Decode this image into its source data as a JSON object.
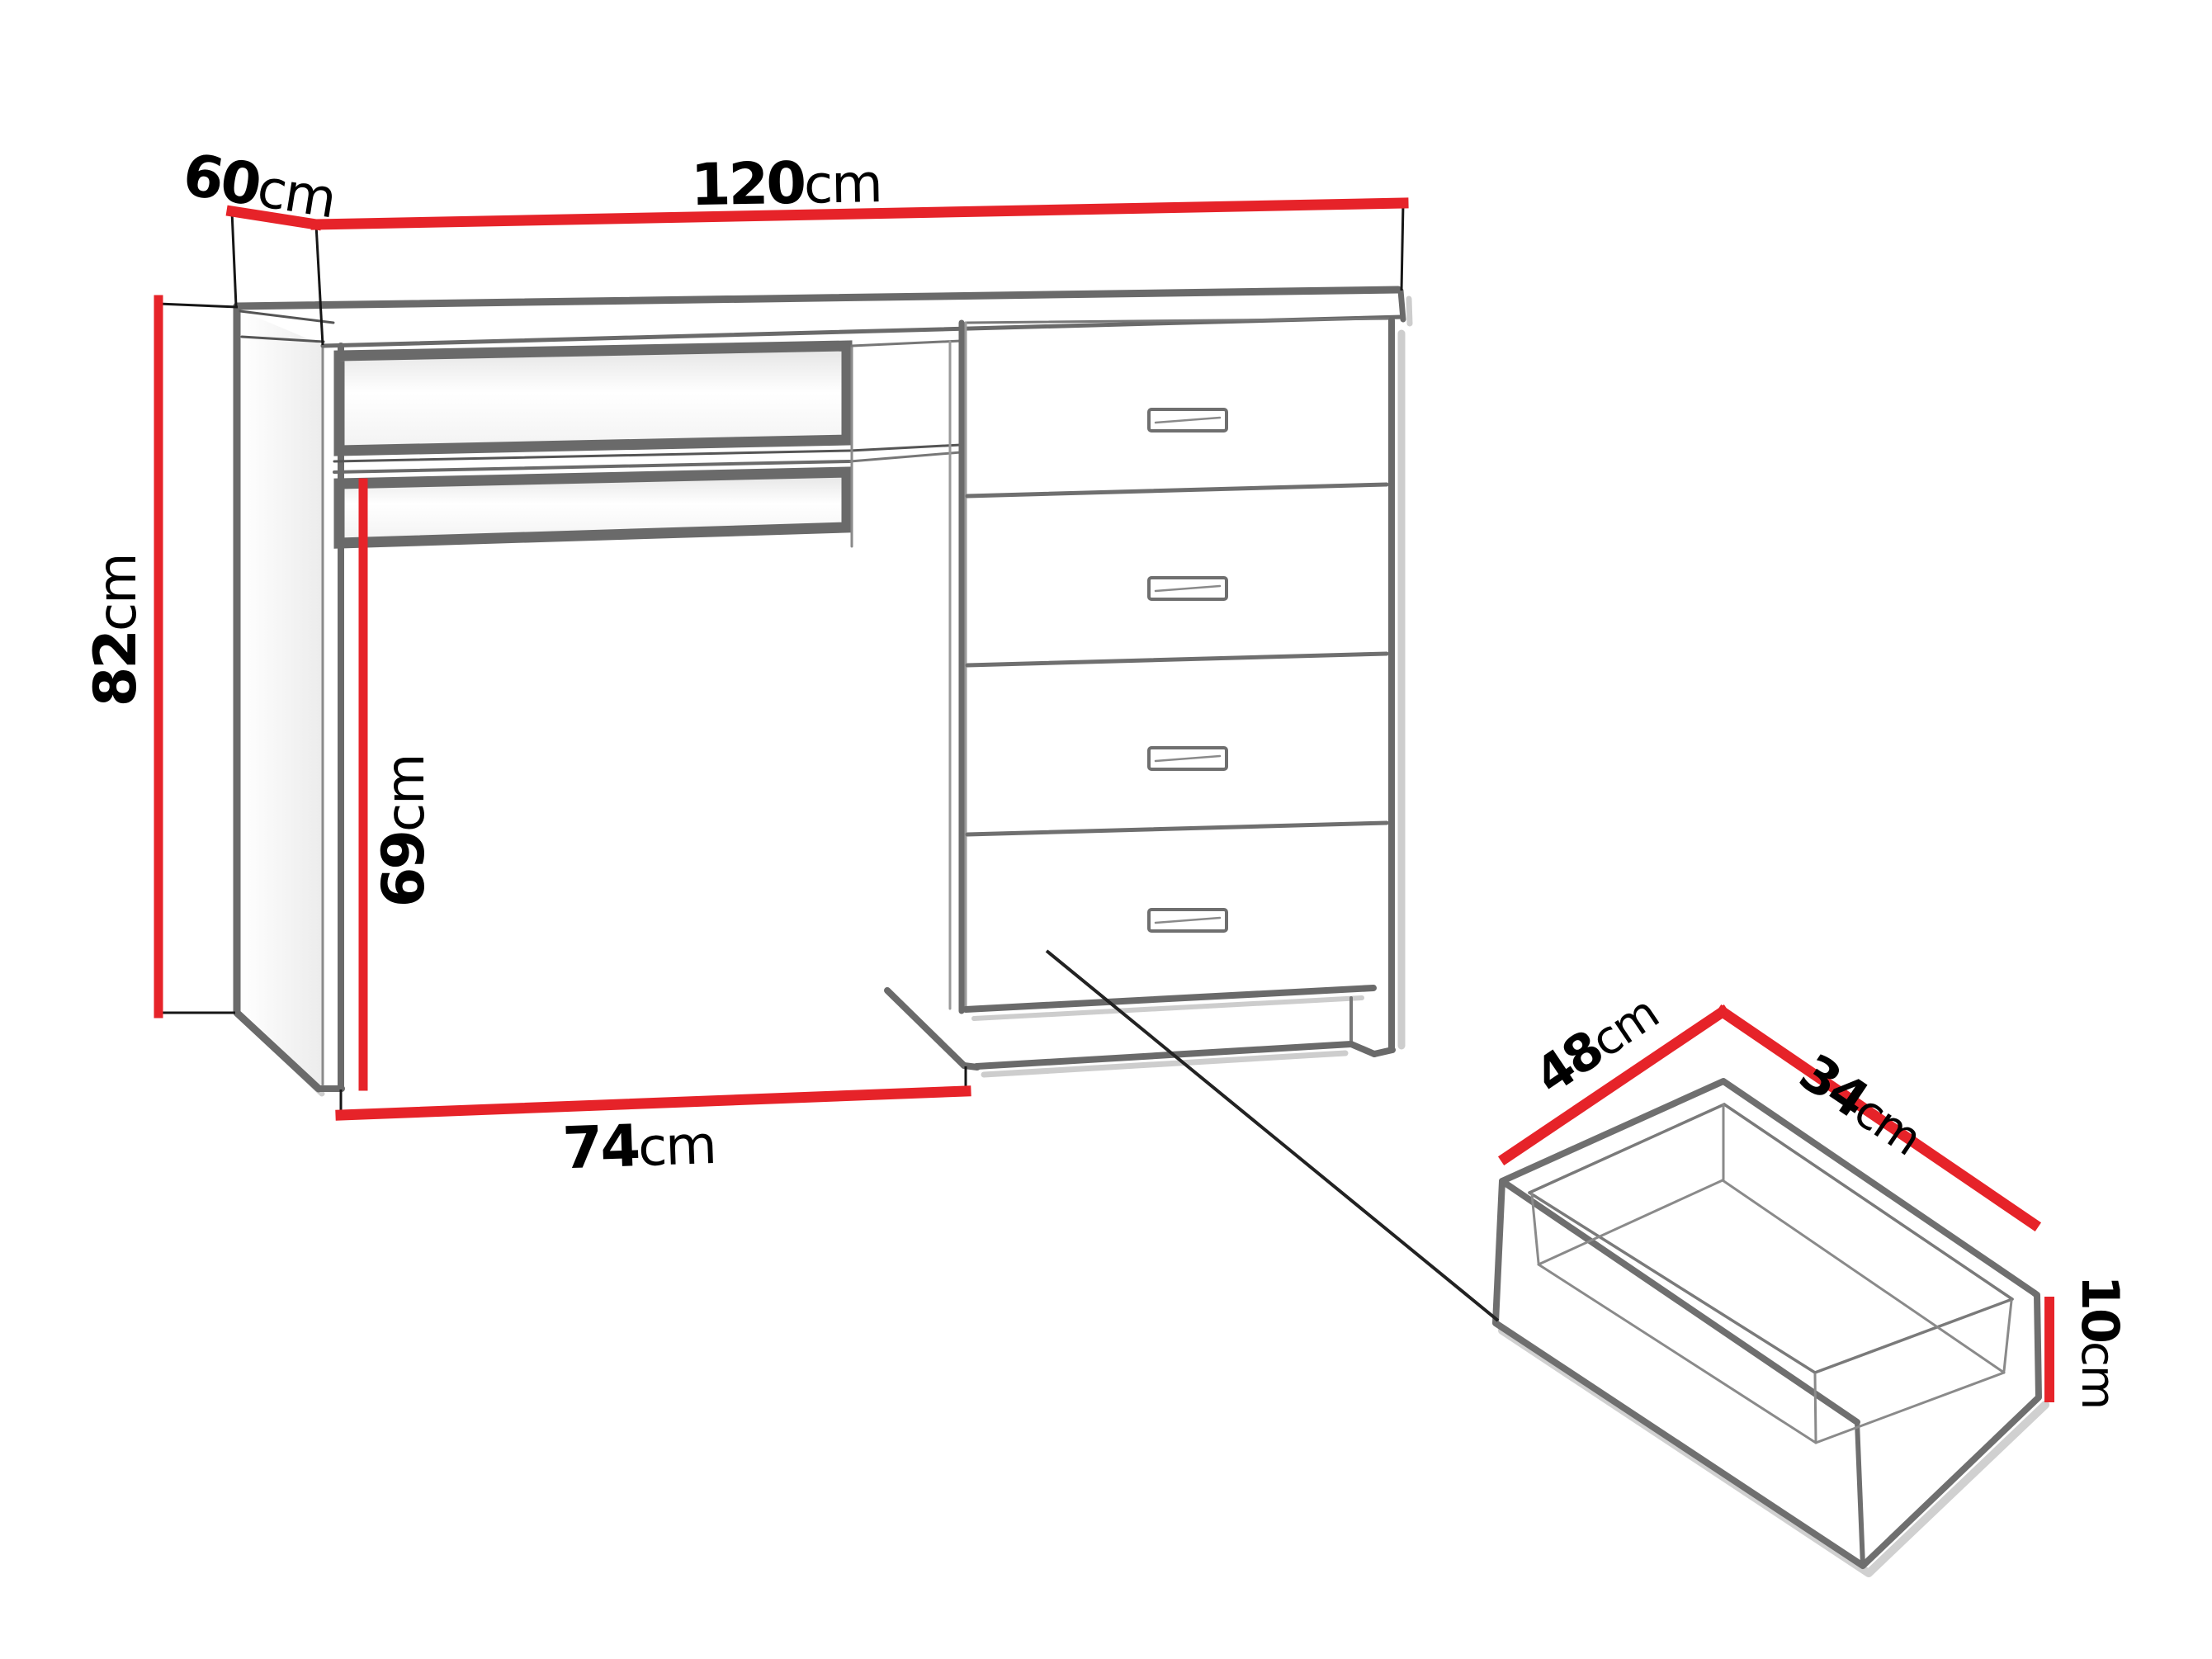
{
  "diagram": {
    "type": "furniture-dimension-diagram",
    "subject": "desk with four drawers, open niche, pull-out shelf and detail of a drawer box",
    "colors": {
      "dimension_line": "#e62329",
      "furniture_outline": "#6a6a6a",
      "tick_line": "#161616",
      "label_text": "#000000",
      "background": "#ffffff"
    },
    "labels": {
      "desk_width": {
        "value": "120",
        "unit": "cm"
      },
      "desk_depth": {
        "value": "60",
        "unit": "cm"
      },
      "desk_height": {
        "value": "82",
        "unit": "cm"
      },
      "knee_height": {
        "value": "69",
        "unit": "cm"
      },
      "knee_width": {
        "value": "74",
        "unit": "cm"
      },
      "drawer_depth": {
        "value": "48",
        "unit": "cm"
      },
      "drawer_width": {
        "value": "34",
        "unit": "cm"
      },
      "drawer_height": {
        "value": "10",
        "unit": "cm"
      }
    }
  }
}
